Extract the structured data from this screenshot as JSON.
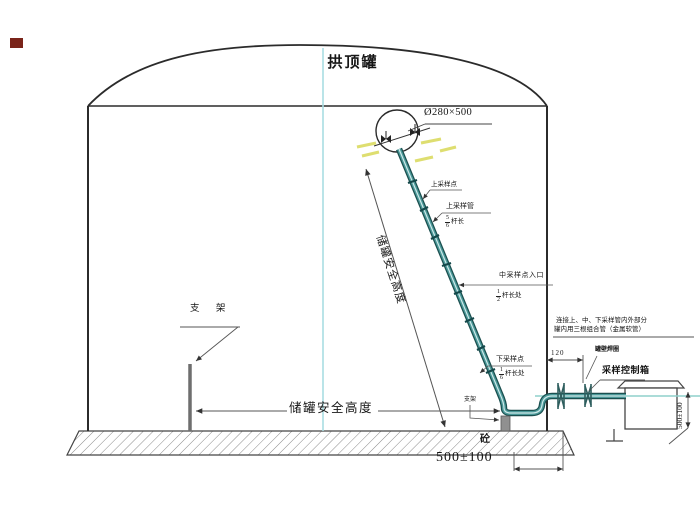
{
  "title": "拱顶罐",
  "colors": {
    "pipe_teal": "#2f7f7f",
    "pipe_dark": "#1b4f4f",
    "centerline_cyan": "#a8dde2",
    "axis_teal": "#8fd0cc",
    "highlight_yellow": "#dede70",
    "corner_mark_red": "#7a241a",
    "line_gray": "#3a3a3a"
  },
  "labels": {
    "nozzle_dim": "Ø280×500",
    "upper_point": "上采样点",
    "upper_pipe": "上采样管",
    "upper_frac": {
      "num": "5",
      "den": "6",
      "suffix": "杆长"
    },
    "mid_point": "中采样点入口",
    "mid_frac": {
      "num": "1",
      "den": "2",
      "suffix": "杆长处"
    },
    "lower_point": "下采样点",
    "lower_frac": {
      "num": "1",
      "den": "6",
      "suffix": "杆长处"
    },
    "note_line1": "连接上、中、下采样管内外部分",
    "note_line2": "罐内用三根组合管（金属软管）",
    "wall_ring": "罐壁焊圈",
    "control_box": "采样控制箱",
    "dim_wall_offset": "120",
    "dim_box_height": "500±100",
    "dim_bottom": "500±100",
    "support": "支 架",
    "support_small": "支架",
    "safe_height_diagonal": "储罐安全高度",
    "safe_height_horizontal": "储罐安全高度",
    "concrete": "砼"
  }
}
